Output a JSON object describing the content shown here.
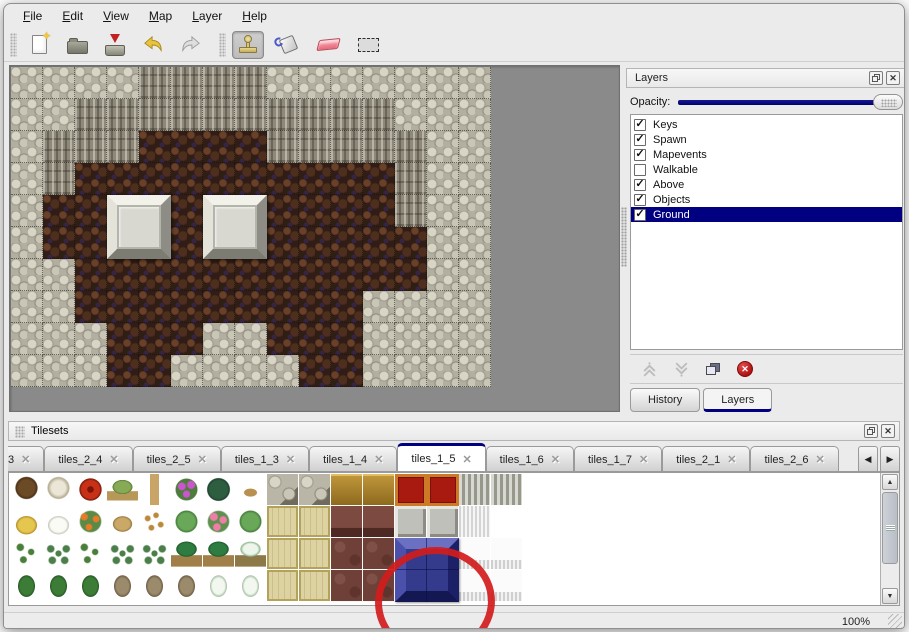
{
  "menubar": {
    "items": [
      {
        "label": "File"
      },
      {
        "label": "Edit"
      },
      {
        "label": "View"
      },
      {
        "label": "Map"
      },
      {
        "label": "Layer"
      },
      {
        "label": "Help"
      }
    ]
  },
  "toolbar": {
    "buttons": [
      {
        "name": "new-file",
        "icon": "page-with-star-icon",
        "active": false
      },
      {
        "name": "open",
        "icon": "folder-icon",
        "active": false
      },
      {
        "name": "save",
        "icon": "drive-red-down-arrow-icon",
        "active": false
      },
      {
        "name": "undo",
        "icon": "curved-arrow-left-icon",
        "active": false
      },
      {
        "name": "redo",
        "icon": "curved-arrow-right-icon",
        "active": false
      },
      {
        "name": "stamp-tool",
        "icon": "stamp-icon",
        "active": true
      },
      {
        "name": "fill-tool",
        "icon": "paint-bucket-icon",
        "active": false
      },
      {
        "name": "eraser-tool",
        "icon": "eraser-icon",
        "active": false
      },
      {
        "name": "select-tool",
        "icon": "dashed-rectangle-icon",
        "active": false
      }
    ]
  },
  "layers_panel": {
    "title": "Layers",
    "opacity_label": "Opacity:",
    "opacity_value": "100",
    "layers": [
      {
        "name": "Keys",
        "checked": true,
        "selected": false
      },
      {
        "name": "Spawn",
        "checked": true,
        "selected": false
      },
      {
        "name": "Mapevents",
        "checked": true,
        "selected": false
      },
      {
        "name": "Walkable",
        "checked": false,
        "selected": false
      },
      {
        "name": "Above",
        "checked": true,
        "selected": false
      },
      {
        "name": "Objects",
        "checked": true,
        "selected": false
      },
      {
        "name": "Ground",
        "checked": true,
        "selected": true
      }
    ],
    "buttons": [
      "move-layer-up",
      "move-layer-down",
      "duplicate-layer",
      "delete-layer"
    ],
    "tabs": [
      {
        "label": "History",
        "active": false
      },
      {
        "label": "Layers",
        "active": true
      }
    ]
  },
  "tilesets_panel": {
    "title": "Tilesets",
    "tabs": [
      {
        "label": "3",
        "active": false,
        "partial": true
      },
      {
        "label": "tiles_2_4",
        "active": false
      },
      {
        "label": "tiles_2_5",
        "active": false
      },
      {
        "label": "tiles_1_3",
        "active": false
      },
      {
        "label": "tiles_1_4",
        "active": false
      },
      {
        "label": "tiles_1_5",
        "active": true
      },
      {
        "label": "tiles_1_6",
        "active": false
      },
      {
        "label": "tiles_1_7",
        "active": false
      },
      {
        "label": "tiles_2_1",
        "active": false
      },
      {
        "label": "tiles_2_6",
        "active": false
      }
    ]
  },
  "statusbar": {
    "zoom": "100%"
  },
  "icons": {
    "close_glyph": "✕",
    "tab_close_glyph": "✕",
    "check_glyph": "✓",
    "star_glyph": "✦",
    "scroll_left_glyph": "◀",
    "scroll_right_glyph": "▶",
    "scroll_up_glyph": "▲",
    "scroll_down_glyph": "▼",
    "delete_glyph": "✕"
  },
  "colors": {
    "selection_navy": "#000080",
    "annotation_red": "#d21c1c",
    "map_background": "#8a8a8a"
  },
  "map": {
    "tile_size": 32,
    "columns": 15,
    "rows": 10,
    "legend": {
      "S": "light-rock-scales",
      "C": "cliff-face",
      "F": "brown-cobble-floor"
    },
    "grid": [
      "SSSSCCCCSSSSSSS",
      "SSCCCCCCCCCCSSS",
      "SCCCFFFFCCCCCSS",
      "SCFFFFFFFFFFCSS",
      "SFFFFFFFFFFFCSS",
      "SFFFFFFFFFFFFSS",
      "SSFFFFFFFFFFFSS",
      "SSFFFFFFFFFSSSS",
      "SSSFFFSSFFFSSSS",
      "SSSFFSSSSFFSSSS"
    ],
    "pillars": [
      {
        "col": 3,
        "row": 4,
        "span": 2
      },
      {
        "col": 6,
        "row": 4,
        "span": 2
      }
    ]
  },
  "tileset_grid": {
    "tile_size": 32,
    "rows": [
      [
        "tree",
        "deadtree",
        "redbloom",
        "stump",
        "trunk",
        "purplebush",
        "fern",
        "twig",
        "stone",
        "stone",
        "goldwood",
        "goldwood",
        "redcarpet",
        "redcarpet",
        "grayridge",
        "grayridge"
      ],
      [
        "hay",
        "snowmound",
        "orangeflower",
        "drygrass",
        "leaves",
        "lilypad",
        "pinkflower",
        "lilypad",
        "goldfloor",
        "goldfloor",
        "brownwood",
        "brownwood",
        "gray3d",
        "gray3d",
        "whitefluff",
        "empty"
      ],
      [
        "sprout",
        "bush",
        "sprout",
        "bush",
        "bush",
        "palm",
        "palm",
        "snowpalm",
        "goldfloor",
        "goldfloor",
        "browntile",
        "browntile",
        "blue",
        "blue",
        "fringe",
        "fringe"
      ],
      [
        "conetree",
        "conetree",
        "conetree",
        "deadtwist",
        "deadtwist",
        "deadtwist",
        "snowcone",
        "snowcone",
        "goldfloor",
        "goldfloor",
        "browntile",
        "browntile",
        "blue",
        "blue",
        "fringe",
        "fringe"
      ]
    ],
    "blue_block": {
      "col": 12,
      "row": 2,
      "span": 2
    },
    "annotation": {
      "type": "red-circle",
      "around": "blue-block"
    }
  }
}
